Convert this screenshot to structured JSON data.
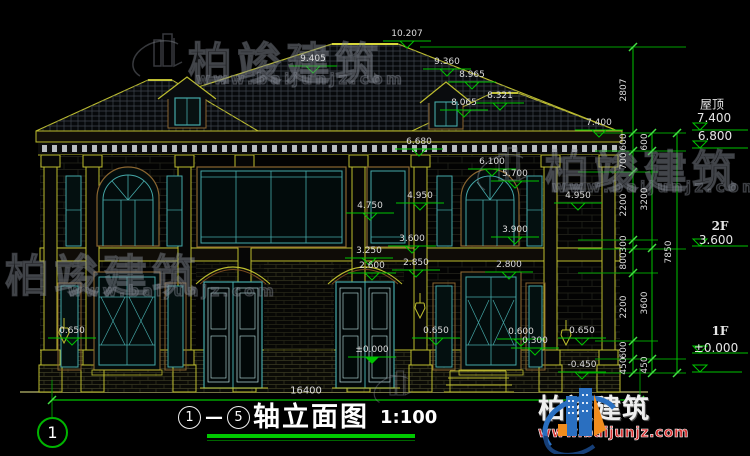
{
  "drawing": {
    "axis_bubble": "1",
    "bottom_width": "16400",
    "dims": [
      "10.207",
      "9.405",
      "9.360",
      "8.965",
      "8.321",
      "8.065",
      "7.400",
      "6.680",
      "6.100",
      "5.700",
      "4.950",
      "4.750",
      "4.950",
      "3.900",
      "3.600",
      "3.250",
      "2.600",
      "2.850",
      "2.800",
      "0.650",
      "0.650",
      "0.600",
      "0.300",
      "0.650",
      "±0.000",
      "-0.450"
    ]
  },
  "right_levels": {
    "roof_label": "屋顶",
    "roof_value": "7.400",
    "eave_value": "6.800",
    "f2_label": "2F",
    "f2_value": "3.600",
    "f1_label": "1F",
    "f1_value": "±0.000"
  },
  "chains": {
    "a": [
      "2807",
      "600",
      "700",
      "2200",
      "300",
      "800",
      "2200",
      "600",
      "450"
    ],
    "b": [
      "600",
      "3200",
      "3600",
      "450"
    ],
    "total": "7850"
  },
  "title": {
    "from": "1",
    "dash": "—",
    "to": "5",
    "name": "轴立面图",
    "scale": "1:100"
  },
  "watermark": {
    "brand": "柏竣建筑",
    "url": "www.baijunjz.com"
  },
  "logo": {
    "brand": "柏竣建筑",
    "url": "www.baijunjz.com"
  }
}
